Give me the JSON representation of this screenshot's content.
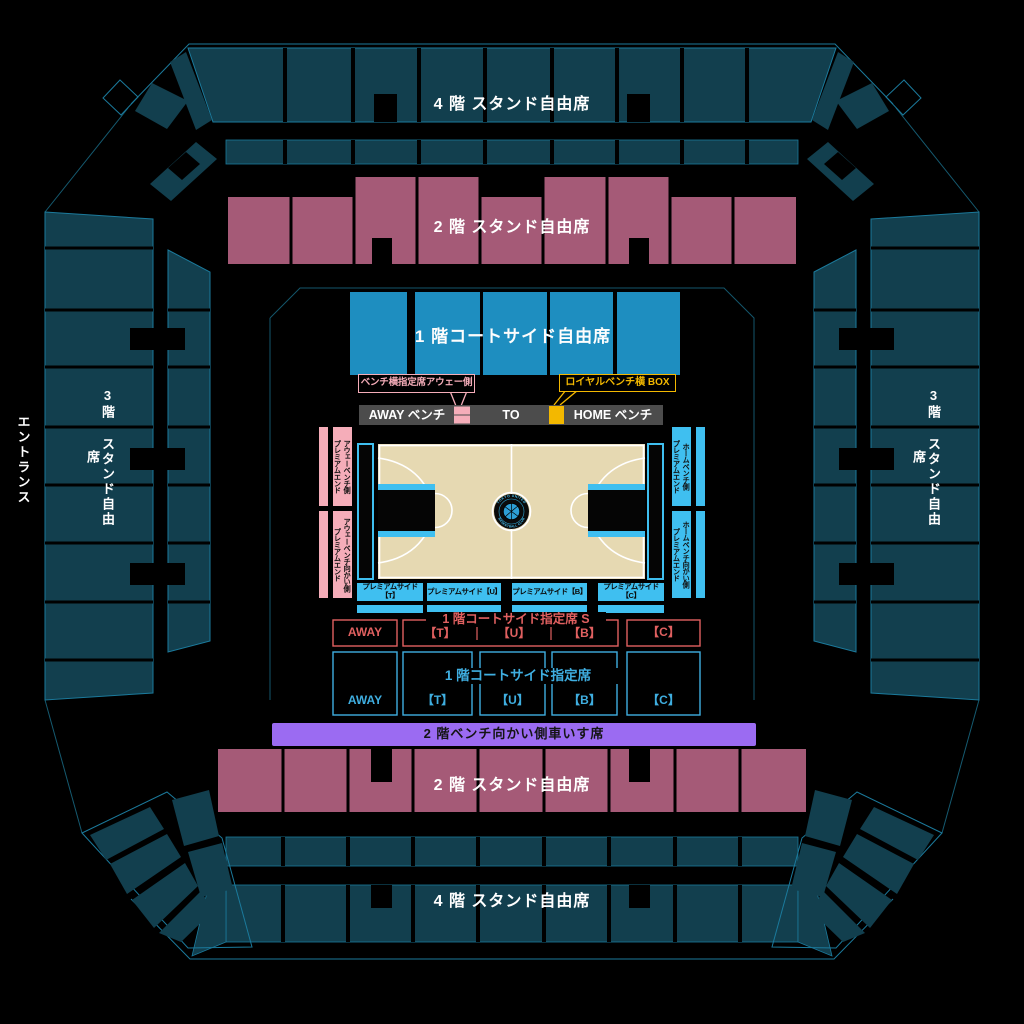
{
  "sections": {
    "stand_4f_top": {
      "label": "4 階 スタンド自由席"
    },
    "stand_2f_top": {
      "label": "2 階 スタンド自由席"
    },
    "courtside_1f_free": {
      "label": "1 階コートサイド自由席"
    },
    "stand_3f_left": {
      "label": "3階 スタンド自由席"
    },
    "stand_3f_right": {
      "label": "3階 スタンド自由席"
    },
    "entrance": {
      "label": "エントランス"
    },
    "wheelchair_2f": {
      "label": "2 階ベンチ向かい側車いす席"
    },
    "stand_2f_bottom": {
      "label": "2 階 スタンド自由席"
    },
    "stand_4f_bottom": {
      "label": "4 階 スタンド自由席"
    }
  },
  "callouts": {
    "bench_side_away": {
      "label": "ベンチ横指定席アウェー側"
    },
    "royal_box": {
      "label": "ロイヤルベンチ横 BOX"
    }
  },
  "bench_bar": {
    "away": "AWAY ベンチ",
    "to": "TO",
    "home": "HOME ベンチ"
  },
  "premium_end": {
    "away_side": "アウェーベンチ側\nプレミアムエンド",
    "away_opposite": "アウェーベンチ向かい側\nプレミアムエンド",
    "home_side": "ホームベンチ側\nプレミアムエンド",
    "home_opposite": "ホームベンチ向かい側\nプレミアムエンド"
  },
  "premium_side": {
    "labels": [
      "プレミアムサイド【T】",
      "プレミアムサイド【U】",
      "プレミアムサイド【B】",
      "プレミアムサイド【C】"
    ]
  },
  "courtside_s": {
    "title": "1 階コートサイド指定席 S",
    "away": "AWAY",
    "blocks": [
      "【T】",
      "【U】",
      "【B】"
    ],
    "block_c": "【C】"
  },
  "courtside_reserved": {
    "title": "1 階コートサイド指定席",
    "away": "AWAY",
    "blocks": [
      "【T】",
      "【U】",
      "【B】",
      "【C】"
    ]
  },
  "logo": {
    "top": "TOKYO UNITED",
    "bottom": "BASKETBALL CLUB"
  },
  "colors": {
    "stand_teal": "#123F4E",
    "outline_teal": "#1B7A9C",
    "stand_pink": "#A55A77",
    "courtside_blue": "#1E8EC0",
    "cyan": "#3FBFF0",
    "salmon": "#F5ADB9",
    "gold": "#F3B800",
    "court_cream": "#E6D9B2",
    "wheelchair_purple": "#9B6BF2",
    "reserved_s_red": "#E06060",
    "reserved_blue": "#3FAEE0",
    "bench_gray": "#4C4C4C"
  }
}
